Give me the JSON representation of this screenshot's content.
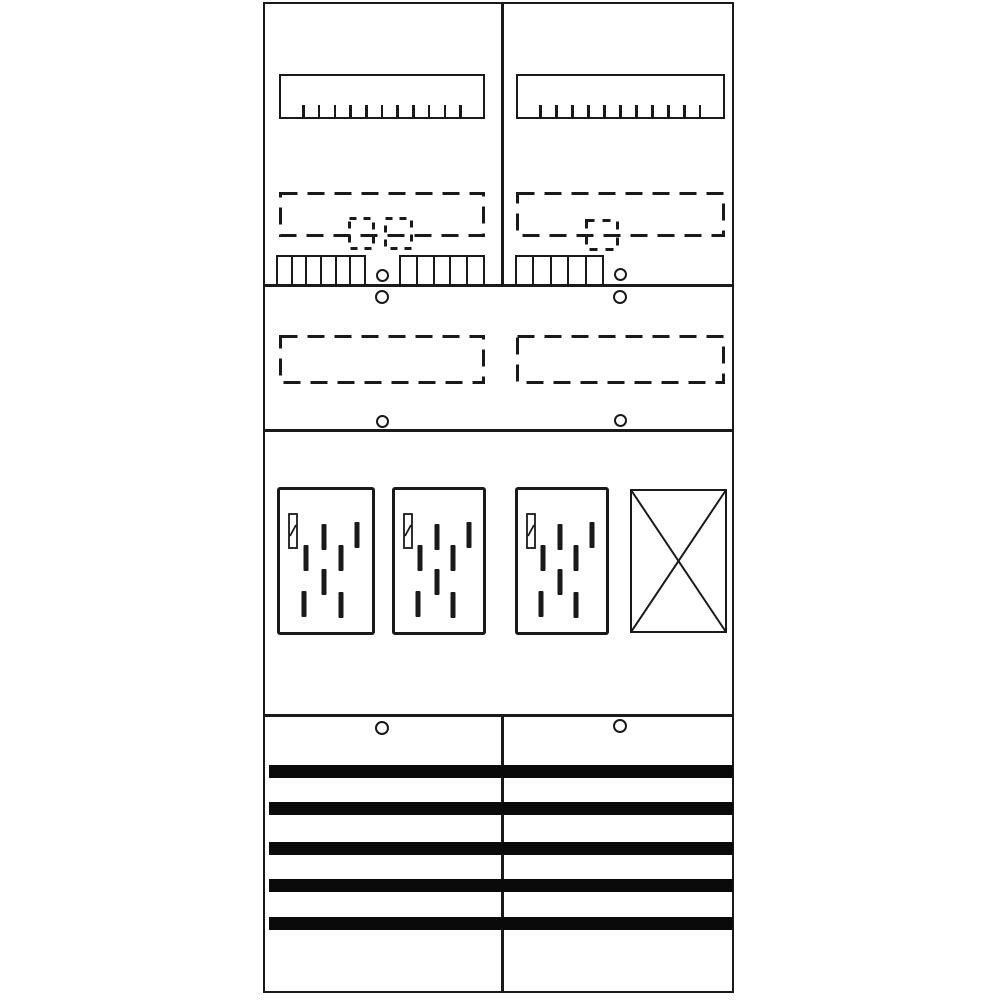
{
  "colors": {
    "ink": "#1a1a1a",
    "background": "#ffffff",
    "busbar": "#0a0a0a"
  },
  "board": {
    "type": "two-field meter distribution board diagram",
    "field_count": 2
  },
  "top_fields": [
    {
      "side": "left",
      "ruler_ticks": 11,
      "reserve_slot_markers": 2,
      "comb_cells": [
        6,
        5
      ],
      "screw_count": 2
    },
    {
      "side": "right",
      "ruler_ticks": 11,
      "reserve_slot_markers": 1,
      "comb_cells": [
        5
      ],
      "screw_count": 2
    }
  ],
  "mid_fields": [
    {
      "side": "left",
      "screw_count": 1
    },
    {
      "side": "right",
      "screw_count": 1
    }
  ],
  "meter_section": {
    "meter_count": 3,
    "hatch_marks_pct": [
      [
        48,
        33
      ],
      [
        84,
        32
      ],
      [
        28,
        48
      ],
      [
        66,
        48
      ],
      [
        48,
        65
      ],
      [
        26,
        80
      ],
      [
        66,
        81
      ]
    ],
    "has_seal_mark": true,
    "blank_cover_crossed": true
  },
  "bottom_section": {
    "busbar_count": 5,
    "screw_count": 2
  }
}
